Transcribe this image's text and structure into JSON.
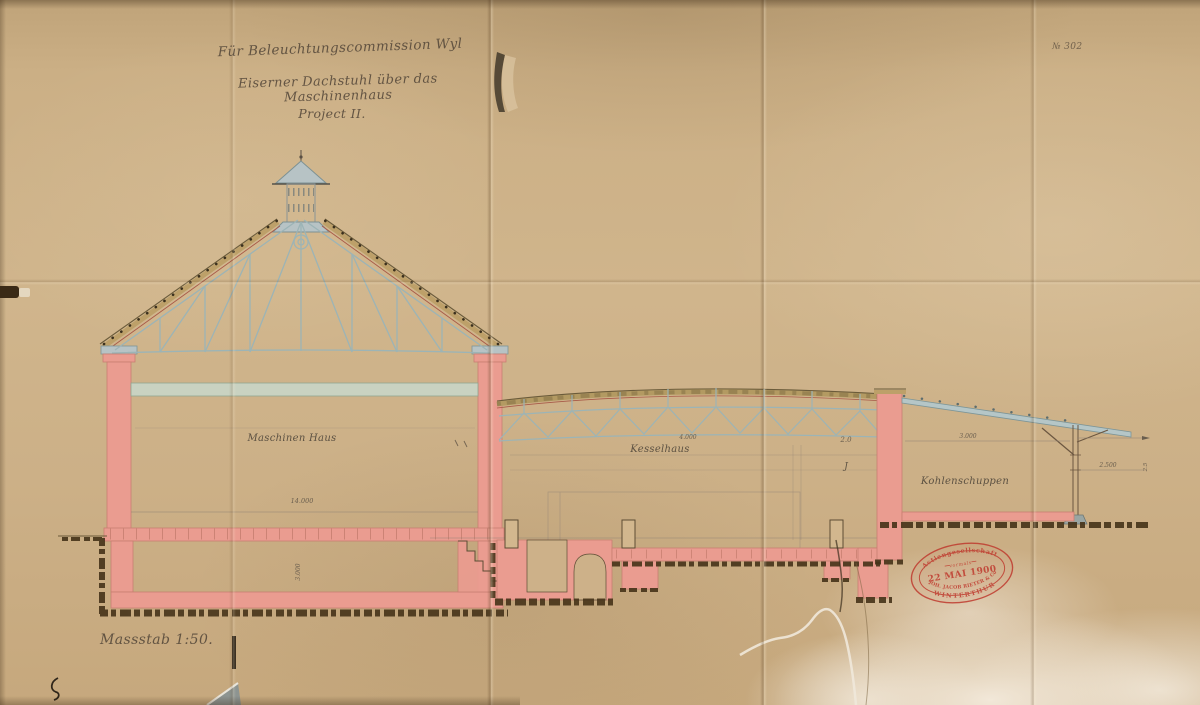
{
  "titleblock": {
    "line1": "Für Beleuchtungscommission Wyl",
    "line2": "Eiserner Dachstuhl über das Maschinenhaus",
    "line3": "Project II.",
    "sheet_number": "№ 302",
    "scale_note": "Massstab 1:50."
  },
  "labels": {
    "maschinenhaus": "Maschinen Haus",
    "kesselhaus": "Kesselhaus",
    "kohlenschuppen": "Kohlenschuppen"
  },
  "dimensions": {
    "maschinenhaus_span": "14.000",
    "maschinenhaus_depth": "3.000",
    "kesselhaus_width": "4.000",
    "kesselhaus_small": "2.0",
    "kesselhaus_mark": "J",
    "kesselhaus_height": "4.000",
    "kohlenschuppen_span": "3.000",
    "kohlenschuppen_overhang": "2.500",
    "kohlenschuppen_height": "2.5"
  },
  "stamp": {
    "arc_top": "Actiengesellschaft",
    "vormals": "vormals",
    "date": "22 MAI 1900",
    "arc_company": "JOH. JACOB RIETER & Co",
    "arc_city": "WINTERTHUR",
    "color": "#bf3a2e"
  },
  "colors": {
    "paper": "#cdb189",
    "masonry_pink": "#ea9c90",
    "ironwork_blue": "#9cb4b6",
    "earth_brown": "#463319",
    "ink": "#55483a",
    "stamp_red": "#bf3a2e"
  }
}
